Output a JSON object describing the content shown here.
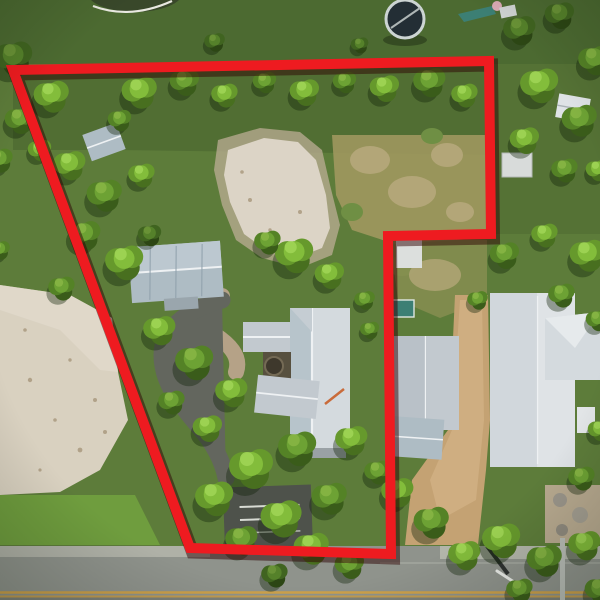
{
  "image": {
    "kind": "aerial-drone-photo",
    "description": "Top-down aerial photograph of a residential lot outlined with a thick red property-boundary line; houses with gray metal roofs, trees, sandy clearings, a round pool at top and a street along the bottom edge",
    "width": 600,
    "height": 600
  },
  "palette": {
    "boundary_red": "#ee1b20",
    "boundary_shadow": "rgba(45,4,4,0.5)",
    "lawn_top": "#4c6a31",
    "grass_base": "#5d7c3a",
    "grass_olive": "#6f8f44",
    "grass_bright": "#6f9d3e",
    "grass_dark": "#47622e",
    "dry_grass": "#a39a62",
    "dry_tan": "#b3a678",
    "sand": "#d9d1c0",
    "sand_shadow": "#bcae95",
    "dirt_path": "#c4a273",
    "asphalt": "#63665e",
    "asphalt_dark": "#4e524b",
    "road": "#8f938c",
    "road_dark": "#7d817a",
    "curb": "#b2b5aa",
    "yellow_line": "#cda14a",
    "roof_light": "#d4dade",
    "roof_mid": "#c2c9cf",
    "roof_shaded": "#aebcc4",
    "roof_white": "#dfe3e6",
    "ridge": "#eef1f3",
    "pool_water": "#232e35",
    "pool_rim": "#ccd4d3",
    "teal_shed": "#3c7f74",
    "pink_toy": "#d9a9b4"
  },
  "annotation": {
    "name": "property-boundary",
    "shape": "closed-polygon",
    "stroke_width": 10,
    "vertices": [
      [
        13,
        70
      ],
      [
        489,
        61
      ],
      [
        491,
        234
      ],
      [
        388,
        236
      ],
      [
        391,
        554
      ],
      [
        190,
        548
      ]
    ]
  },
  "scene": {
    "objects": {
      "pool": "round above-ground pool, top of frame",
      "playset": "small pink/teal play structure, top right",
      "shed_small": "small gray shed inside boundary, upper left",
      "garage": "gray metal-roof outbuilding inside boundary",
      "main_house": "large gray metal-roof house inside boundary",
      "neighbor_house_mid": "white-roof neighbor house right of boundary",
      "neighbor_house_right": "large white-roof neighbor house, right edge",
      "notch_shed": "small light shed below boundary notch",
      "white_shed_topright": "white shed, upper right neighbor yard",
      "trailer_topright": "small white trailer, upper right",
      "driveway": "asphalt driveway curving to parking pad",
      "parking_pad": "dark parking pad with white stripes",
      "dirt_driveway": "tan dirt driveway, neighbor lot",
      "road": "paved street along bottom with double yellow line",
      "utility_pole": "utility pole and shadow at lower right",
      "sand_left": "large sandy clearing, left side",
      "clearing_center": "sandy clearing, center of lot"
    },
    "trees": [
      [
        14,
        58,
        26,
        "d"
      ],
      [
        52,
        96,
        24,
        "b"
      ],
      [
        20,
        120,
        20,
        "m"
      ],
      [
        0,
        160,
        18,
        "m"
      ],
      [
        40,
        150,
        16,
        "b"
      ],
      [
        0,
        250,
        14,
        "m"
      ],
      [
        140,
        92,
        24,
        "b"
      ],
      [
        185,
        82,
        20,
        "m"
      ],
      [
        225,
        95,
        18,
        "b"
      ],
      [
        265,
        82,
        16,
        "m"
      ],
      [
        305,
        92,
        20,
        "b"
      ],
      [
        345,
        82,
        16,
        "m"
      ],
      [
        385,
        88,
        20,
        "b"
      ],
      [
        430,
        82,
        22,
        "m"
      ],
      [
        465,
        95,
        18,
        "b"
      ],
      [
        120,
        120,
        16,
        "m"
      ],
      [
        215,
        42,
        14,
        "d"
      ],
      [
        360,
        45,
        12,
        "d"
      ],
      [
        520,
        30,
        22,
        "d"
      ],
      [
        560,
        15,
        20,
        "d"
      ],
      [
        595,
        60,
        22,
        "m"
      ],
      [
        540,
        85,
        26,
        "b"
      ],
      [
        580,
        120,
        24,
        "m"
      ],
      [
        525,
        140,
        20,
        "b"
      ],
      [
        565,
        170,
        18,
        "m"
      ],
      [
        598,
        170,
        16,
        "b"
      ],
      [
        505,
        255,
        20,
        "m"
      ],
      [
        545,
        235,
        18,
        "b"
      ],
      [
        588,
        255,
        24,
        "b"
      ],
      [
        562,
        295,
        18,
        "m"
      ],
      [
        598,
        320,
        16,
        "m"
      ],
      [
        70,
        165,
        22,
        "b"
      ],
      [
        105,
        195,
        24,
        "m"
      ],
      [
        142,
        175,
        18,
        "b"
      ],
      [
        85,
        235,
        22,
        "m"
      ],
      [
        125,
        262,
        26,
        "b"
      ],
      [
        62,
        288,
        18,
        "m"
      ],
      [
        150,
        235,
        16,
        "d"
      ],
      [
        295,
        255,
        26,
        "b"
      ],
      [
        268,
        242,
        18,
        "m"
      ],
      [
        330,
        275,
        20,
        "b"
      ],
      [
        365,
        300,
        14,
        "m"
      ],
      [
        160,
        330,
        22,
        "b"
      ],
      [
        195,
        362,
        26,
        "m"
      ],
      [
        232,
        392,
        22,
        "b"
      ],
      [
        172,
        402,
        18,
        "m"
      ],
      [
        208,
        428,
        20,
        "b"
      ],
      [
        252,
        468,
        30,
        "b"
      ],
      [
        298,
        448,
        26,
        "m"
      ],
      [
        215,
        498,
        26,
        "b"
      ],
      [
        282,
        518,
        28,
        "b"
      ],
      [
        330,
        498,
        24,
        "m"
      ],
      [
        352,
        440,
        22,
        "b"
      ],
      [
        378,
        472,
        18,
        "m"
      ],
      [
        242,
        540,
        22,
        "m"
      ],
      [
        312,
        548,
        24,
        "b"
      ],
      [
        350,
        565,
        20,
        "m"
      ],
      [
        275,
        575,
        18,
        "d"
      ],
      [
        398,
        492,
        22,
        "b"
      ],
      [
        432,
        522,
        24,
        "m"
      ],
      [
        465,
        555,
        22,
        "b"
      ],
      [
        502,
        540,
        26,
        "b"
      ],
      [
        545,
        560,
        24,
        "m"
      ],
      [
        585,
        545,
        22,
        "b"
      ],
      [
        520,
        590,
        18,
        "m"
      ],
      [
        600,
        590,
        20,
        "m"
      ],
      [
        478,
        300,
        14,
        "m"
      ],
      [
        600,
        430,
        16,
        "b"
      ],
      [
        582,
        478,
        18,
        "m"
      ],
      [
        370,
        330,
        13,
        "m"
      ]
    ]
  }
}
